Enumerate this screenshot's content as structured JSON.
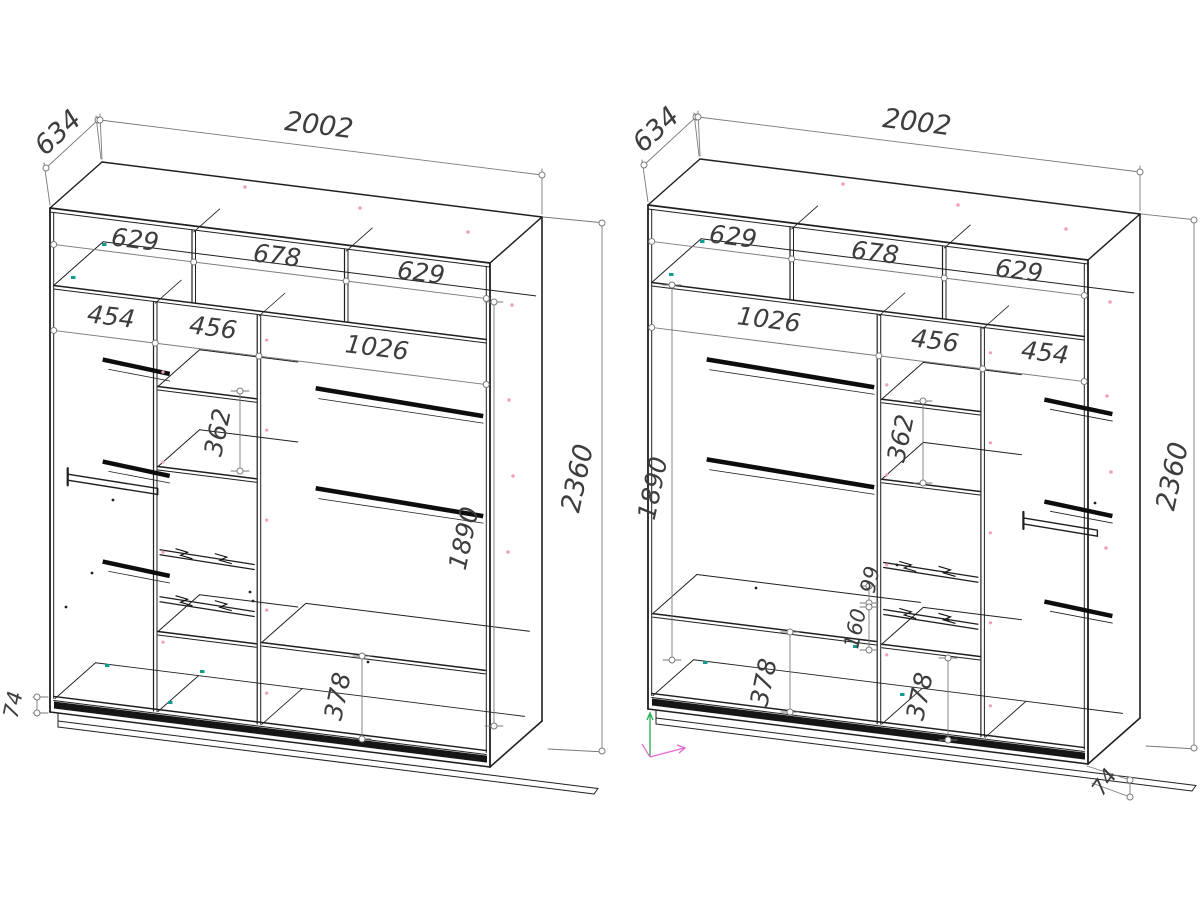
{
  "drawing": {
    "colors": {
      "line": "#1f1f1f",
      "rod": "#0d0d0d",
      "dim": "#7a7a7a",
      "text": "#3d3d3d",
      "hole_pink": "#f29ec0",
      "hole_teal": "#0f9d8f",
      "axis_green": "#2fb457",
      "axis_magenta": "#e86ad0"
    },
    "wardrobes": [
      {
        "name": "wardrobe-left",
        "dims": {
          "depth": "634",
          "width": "2002",
          "height": "2360",
          "plinth": "74",
          "top_sections": [
            "629",
            "678",
            "629"
          ],
          "columns": [
            "454",
            "456",
            "1026"
          ],
          "shelf_spacing": "362",
          "hanging_height": "1890",
          "bottom_section": "378"
        }
      },
      {
        "name": "wardrobe-right",
        "dims": {
          "depth": "634",
          "width": "2002",
          "height": "2360",
          "plinth": "74",
          "top_sections": [
            "629",
            "678",
            "629"
          ],
          "columns": [
            "1026",
            "456",
            "454"
          ],
          "shelf_spacing": "362",
          "hanging_height": "1890",
          "drawer_offset": "99",
          "drawer_spacing": "160",
          "bottom_sections": [
            "378",
            "378"
          ]
        }
      }
    ]
  }
}
